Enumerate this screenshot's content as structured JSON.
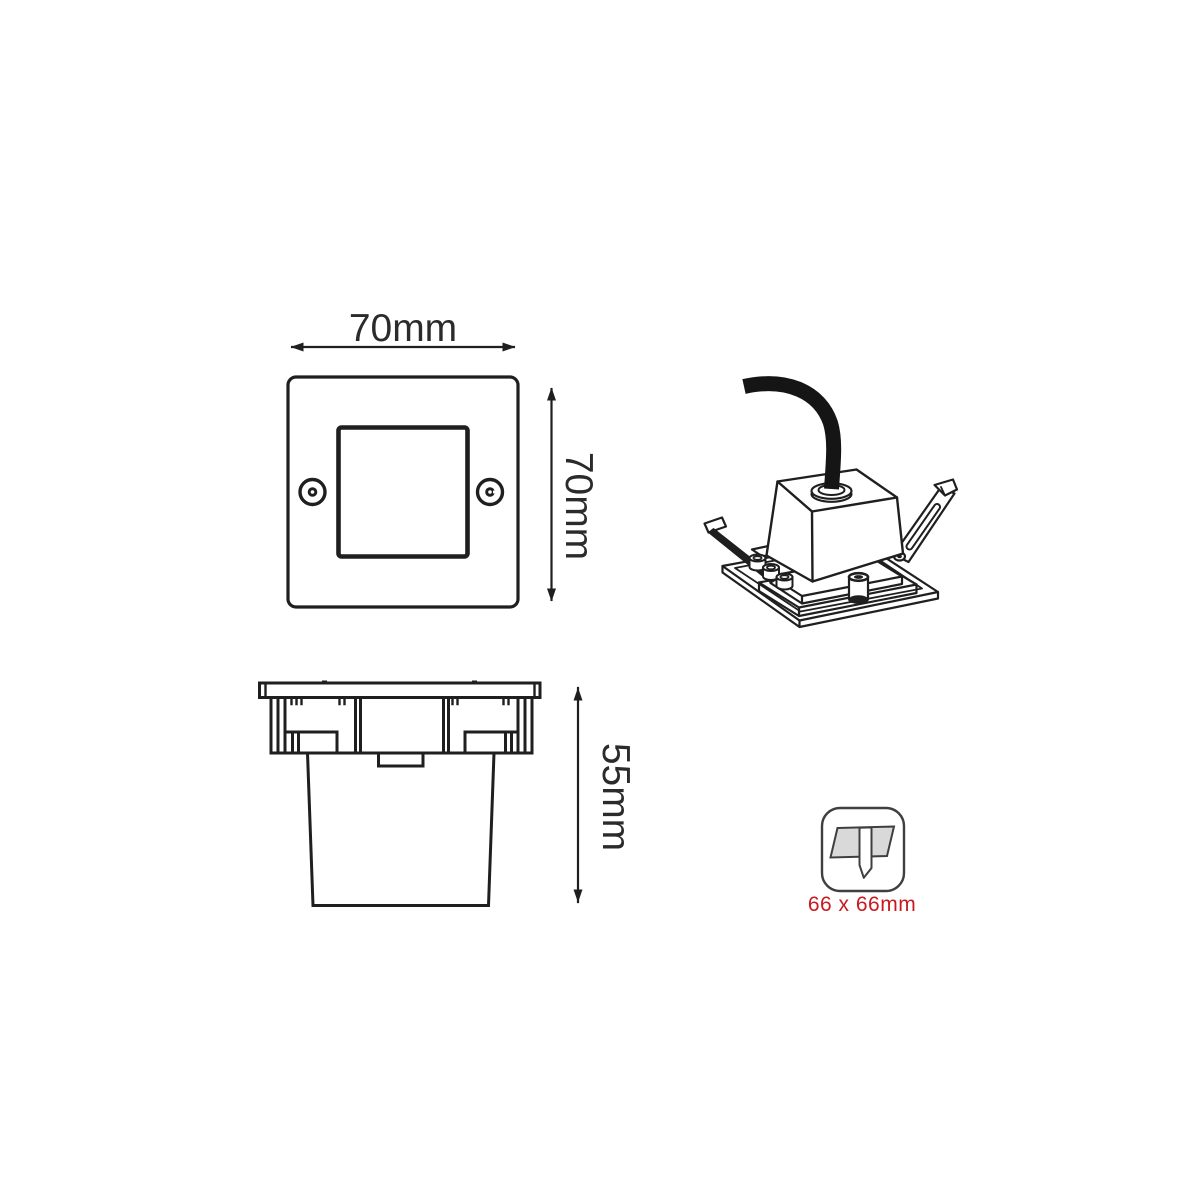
{
  "colors": {
    "line": "#1f1f1f",
    "label_text": "#2b2b2b",
    "accent_red": "#c8191e",
    "icon_panel_fill": "#d9d9d9",
    "icon_stroke": "#3f3f3f"
  },
  "views": {
    "front": {
      "width_label": "70mm",
      "height_label": "70mm"
    },
    "side": {
      "height_label": "55mm"
    },
    "cutout": {
      "size_label": "66 x 66mm",
      "icon": "recessed-cutout-icon"
    }
  }
}
